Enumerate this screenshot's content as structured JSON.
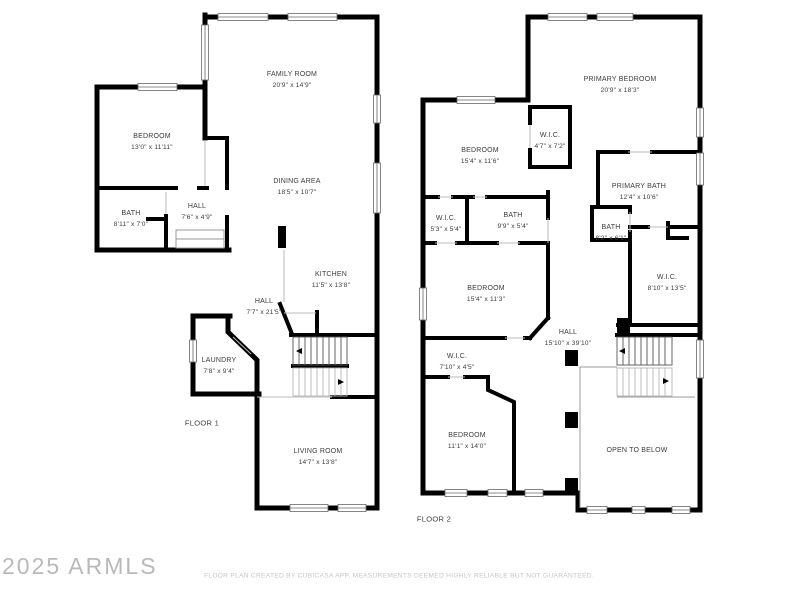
{
  "footer": {
    "watermark": "2025 ARMLS",
    "disclaimer": "FLOOR PLAN CREATED BY CUBICASA APP. MEASUREMENTS DEEMED HIGHLY RELIABLE BUT NOT GUARANTEED."
  },
  "colors": {
    "background": "#ffffff",
    "wall": "#000000",
    "label_text": "#3c3c3c",
    "watermark_text": "#b9b9b9",
    "disclaimer_text": "#c5c5c5"
  },
  "floor1": {
    "label": "FLOOR 1",
    "rooms": [
      {
        "name": "FAMILY ROOM",
        "dims": "20'9\" x 14'9\""
      },
      {
        "name": "BEDROOM",
        "dims": "13'0\" x 11'11\""
      },
      {
        "name": "DINING AREA",
        "dims": "18'5\" x 10'7\""
      },
      {
        "name": "BATH",
        "dims": "8'11\" x 7'0\""
      },
      {
        "name": "HALL",
        "dims": "7'6\" x 4'9\""
      },
      {
        "name": "KITCHEN",
        "dims": "11'5\" x 13'8\""
      },
      {
        "name": "HALL",
        "dims": "7'7\" x 21'5\""
      },
      {
        "name": "LAUNDRY",
        "dims": "7'8\" x 9'4\""
      },
      {
        "name": "LIVING ROOM",
        "dims": "14'7\" x 13'8\""
      }
    ]
  },
  "floor2": {
    "label": "FLOOR 2",
    "rooms": [
      {
        "name": "PRIMARY BEDROOM",
        "dims": "20'9\" x 18'3\""
      },
      {
        "name": "BEDROOM",
        "dims": "15'4\" x 11'6\""
      },
      {
        "name": "W.I.C.",
        "dims": "4'7\" x 7'2\""
      },
      {
        "name": "PRIMARY BATH",
        "dims": "12'4\" x 10'6\""
      },
      {
        "name": "W.I.C.",
        "dims": "5'3\" x 5'4\""
      },
      {
        "name": "BATH",
        "dims": "9'9\" x 5'4\""
      },
      {
        "name": "BATH",
        "dims": "8'2\" x 6'1\""
      },
      {
        "name": "W.I.C.",
        "dims": "8'10\" x 13'5\""
      },
      {
        "name": "BEDROOM",
        "dims": "15'4\" x 11'3\""
      },
      {
        "name": "HALL",
        "dims": "15'10\" x 39'10\""
      },
      {
        "name": "W.I.C.",
        "dims": "7'10\" x 4'5\""
      },
      {
        "name": "BEDROOM",
        "dims": "11'1\" x 14'0\""
      },
      {
        "name": "OPEN TO BELOW",
        "dims": ""
      }
    ]
  }
}
